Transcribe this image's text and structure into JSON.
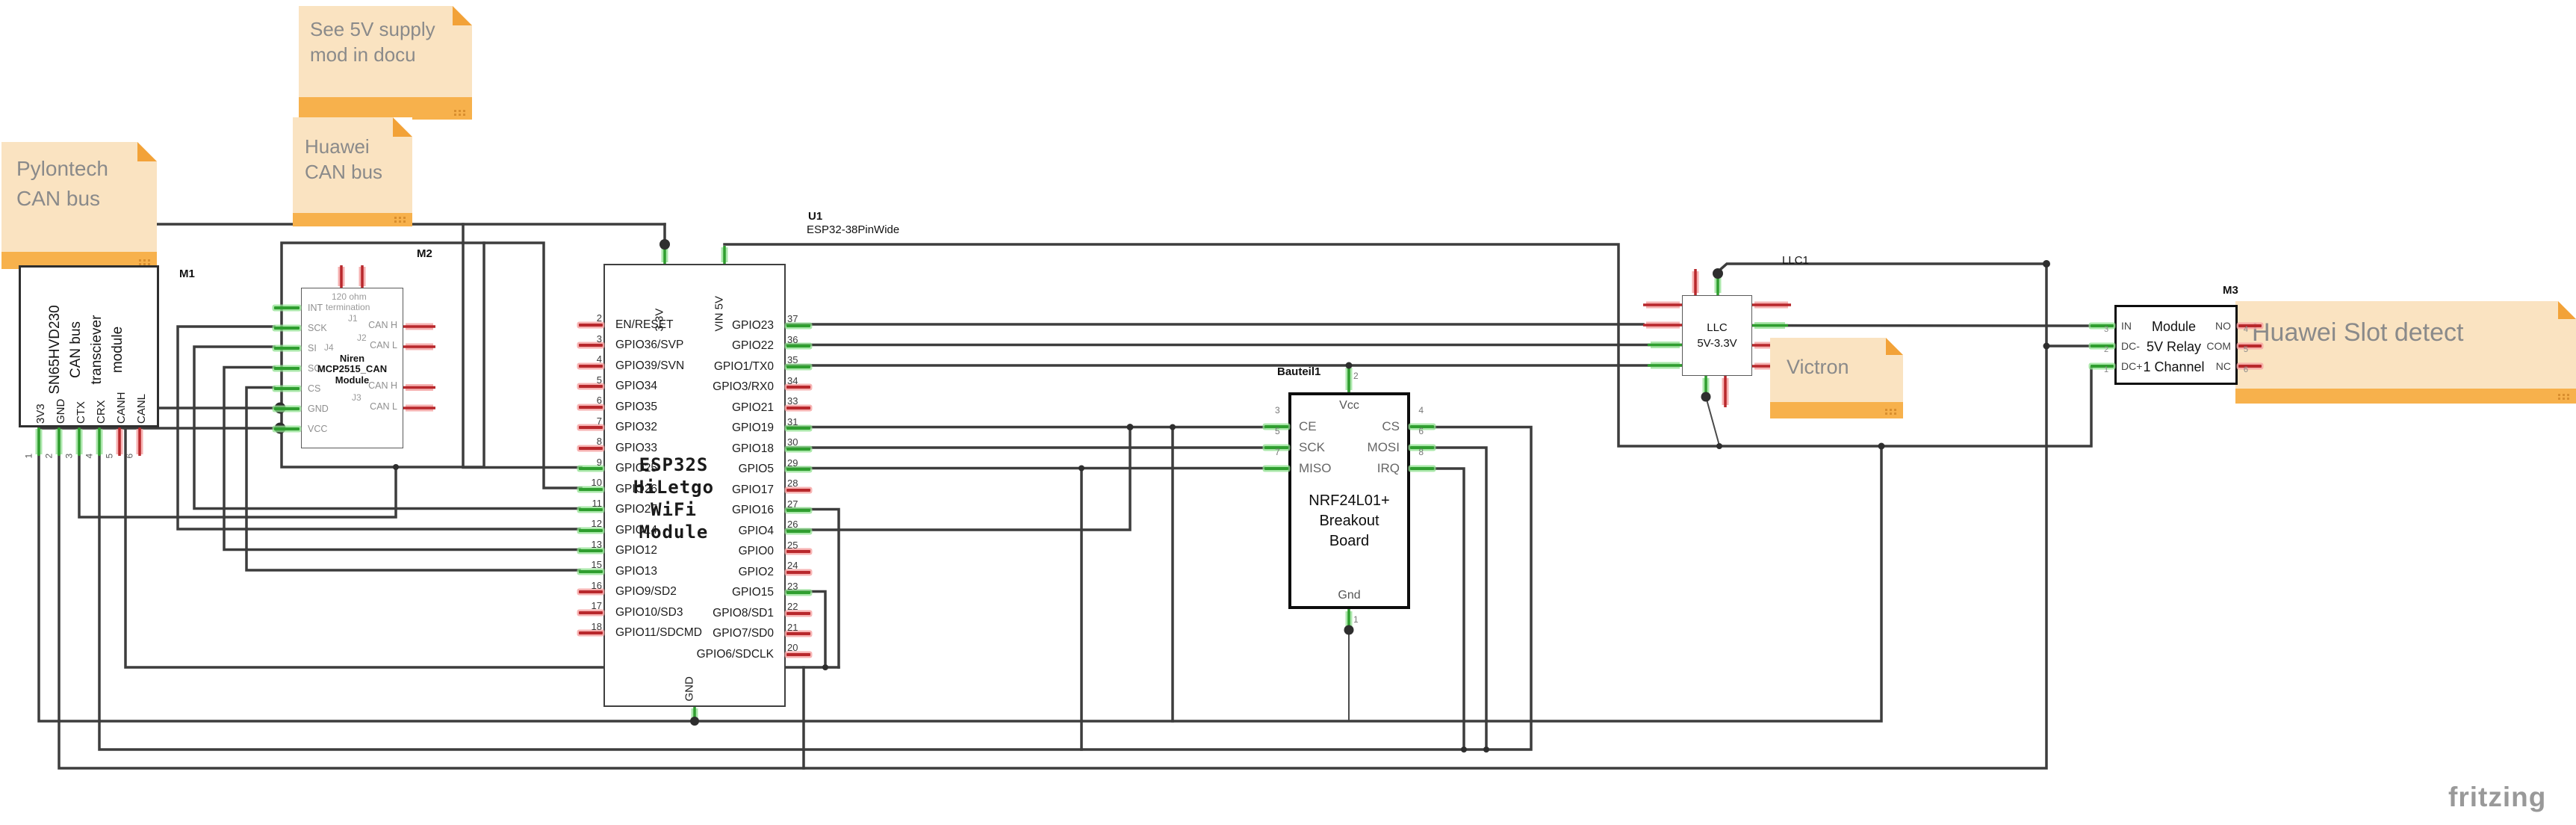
{
  "palette": {
    "wire": "#3d3d3d",
    "pin_green": "#2f9e2f",
    "pin_red": "#b8282c",
    "note_body": "#fae3c1",
    "note_bar": "#f7b14c",
    "note_fold": "#f2a238",
    "note_text": "#8a8a8a"
  },
  "watermark": "fritzing",
  "notes": {
    "supply": {
      "lines": [
        "See 5V supply",
        "mod in docu"
      ]
    },
    "huawei_can": {
      "lines": [
        "Huawei",
        "CAN bus"
      ]
    },
    "pylontech": {
      "lines": [
        "Pylontech",
        "CAN bus"
      ]
    },
    "victron": {
      "lines": [
        "Victron"
      ]
    },
    "slot": {
      "lines": [
        "Huawei Slot detect"
      ]
    }
  },
  "m1": {
    "ref": "M1",
    "body_lines": [
      "SN65HVD230",
      "CAN bus",
      "transciever",
      "module"
    ],
    "pins": [
      {
        "num": "1",
        "label": "3V3",
        "color": "green"
      },
      {
        "num": "2",
        "label": "GND",
        "color": "green"
      },
      {
        "num": "3",
        "label": "CTX",
        "color": "green"
      },
      {
        "num": "4",
        "label": "CRX",
        "color": "green"
      },
      {
        "num": "5",
        "label": "CANH",
        "color": "red"
      },
      {
        "num": "6",
        "label": "CANL",
        "color": "red"
      }
    ]
  },
  "m2": {
    "ref": "M2",
    "termination_note": [
      "120 ohm",
      "termination"
    ],
    "jumper_j1": "J1",
    "jumper_j2": "J2",
    "jumper_j3": "J3",
    "jumper_j4": "J4",
    "name_lines": [
      "Niren",
      "MCP2515_CAN",
      "Module"
    ],
    "left_pins": [
      {
        "label": "INT",
        "color": "green"
      },
      {
        "label": "SCK",
        "color": "green"
      },
      {
        "label": "SI",
        "color": "green"
      },
      {
        "label": "SO",
        "color": "green"
      },
      {
        "label": "CS",
        "color": "green"
      },
      {
        "label": "GND",
        "color": "green"
      },
      {
        "label": "VCC",
        "color": "green"
      }
    ],
    "right_pins": [
      {
        "label": "CAN H"
      },
      {
        "label": "CAN L"
      },
      {
        "label": "CAN H"
      },
      {
        "label": "CAN L"
      }
    ]
  },
  "esp32": {
    "ref": "U1",
    "part": "ESP32-38PinWide",
    "top_pin_1": "3.3V",
    "top_pin_2": "VIN 5V",
    "bottom_pin": "GND",
    "name_lines": [
      "ESP32S",
      "HiLetgo",
      "WiFi",
      "Module"
    ],
    "left_pins": [
      {
        "num": "2",
        "label": "EN/RESET",
        "color": "red"
      },
      {
        "num": "3",
        "label": "GPIO36/SVP",
        "color": "red"
      },
      {
        "num": "4",
        "label": "GPIO39/SVN",
        "color": "red"
      },
      {
        "num": "5",
        "label": "GPIO34",
        "color": "red"
      },
      {
        "num": "6",
        "label": "GPIO35",
        "color": "red"
      },
      {
        "num": "7",
        "label": "GPIO32",
        "color": "red"
      },
      {
        "num": "8",
        "label": "GPIO33",
        "color": "red"
      },
      {
        "num": "9",
        "label": "GPIO25",
        "color": "green"
      },
      {
        "num": "10",
        "label": "GPIO26",
        "color": "green"
      },
      {
        "num": "11",
        "label": "GPIO27",
        "color": "green"
      },
      {
        "num": "12",
        "label": "GPIO14",
        "color": "green"
      },
      {
        "num": "13",
        "label": "GPIO12",
        "color": "green"
      },
      {
        "num": "15",
        "label": "GPIO13",
        "color": "green"
      },
      {
        "num": "16",
        "label": "GPIO9/SD2",
        "color": "red"
      },
      {
        "num": "17",
        "label": "GPIO10/SD3",
        "color": "red"
      },
      {
        "num": "18",
        "label": "GPIO11/SDCMD",
        "color": "red"
      }
    ],
    "right_pins": [
      {
        "num": "37",
        "label": "GPIO23",
        "color": "green"
      },
      {
        "num": "36",
        "label": "GPIO22",
        "color": "green"
      },
      {
        "num": "35",
        "label": "GPIO1/TX0",
        "color": "green"
      },
      {
        "num": "34",
        "label": "GPIO3/RX0",
        "color": "red"
      },
      {
        "num": "33",
        "label": "GPIO21",
        "color": "red"
      },
      {
        "num": "31",
        "label": "GPIO19",
        "color": "green"
      },
      {
        "num": "30",
        "label": "GPIO18",
        "color": "green"
      },
      {
        "num": "29",
        "label": "GPIO5",
        "color": "green"
      },
      {
        "num": "28",
        "label": "GPIO17",
        "color": "red"
      },
      {
        "num": "27",
        "label": "GPIO16",
        "color": "green"
      },
      {
        "num": "26",
        "label": "GPIO4",
        "color": "green"
      },
      {
        "num": "25",
        "label": "GPIO0",
        "color": "red"
      },
      {
        "num": "24",
        "label": "GPIO2",
        "color": "red"
      },
      {
        "num": "23",
        "label": "GPIO15",
        "color": "green"
      },
      {
        "num": "22",
        "label": "GPIO8/SD1",
        "color": "red"
      },
      {
        "num": "21",
        "label": "GPIO7/SD0",
        "color": "red"
      },
      {
        "num": "20",
        "label": "GPIO6/SDCLK",
        "color": "red"
      }
    ]
  },
  "nrf": {
    "ref": "Bauteil1",
    "top_pin": {
      "num": "2",
      "label": "Vcc"
    },
    "bottom_pin": {
      "num": "1",
      "label": "Gnd"
    },
    "left_pins": [
      {
        "num": "3",
        "label": "CE",
        "color": "green"
      },
      {
        "num": "5",
        "label": "SCK",
        "color": "green"
      },
      {
        "num": "7",
        "label": "MISO",
        "color": "green"
      }
    ],
    "right_pins": [
      {
        "num": "4",
        "label": "CS",
        "color": "green"
      },
      {
        "num": "6",
        "label": "MOSI",
        "color": "green"
      },
      {
        "num": "8",
        "label": "IRQ",
        "color": "green"
      }
    ],
    "name_lines": [
      "NRF24L01+",
      "Breakout",
      "Board"
    ]
  },
  "llc": {
    "ref": "LLC1",
    "name_lines": [
      "LLC",
      "5V-3.3V"
    ]
  },
  "relay": {
    "ref": "M3",
    "left_pins": [
      {
        "num": "3",
        "label": "IN",
        "color": "green"
      },
      {
        "num": "2",
        "label": "DC-",
        "color": "green"
      },
      {
        "num": "1",
        "label": "DC+",
        "color": "green"
      }
    ],
    "right_pins": [
      {
        "num": "4",
        "label": "NO",
        "color": "red"
      },
      {
        "num": "5",
        "label": "COM",
        "color": "red"
      },
      {
        "num": "6",
        "label": "NC",
        "color": "red"
      }
    ],
    "name_lines": [
      "Module",
      "5V Relay",
      "1 Channel"
    ]
  }
}
